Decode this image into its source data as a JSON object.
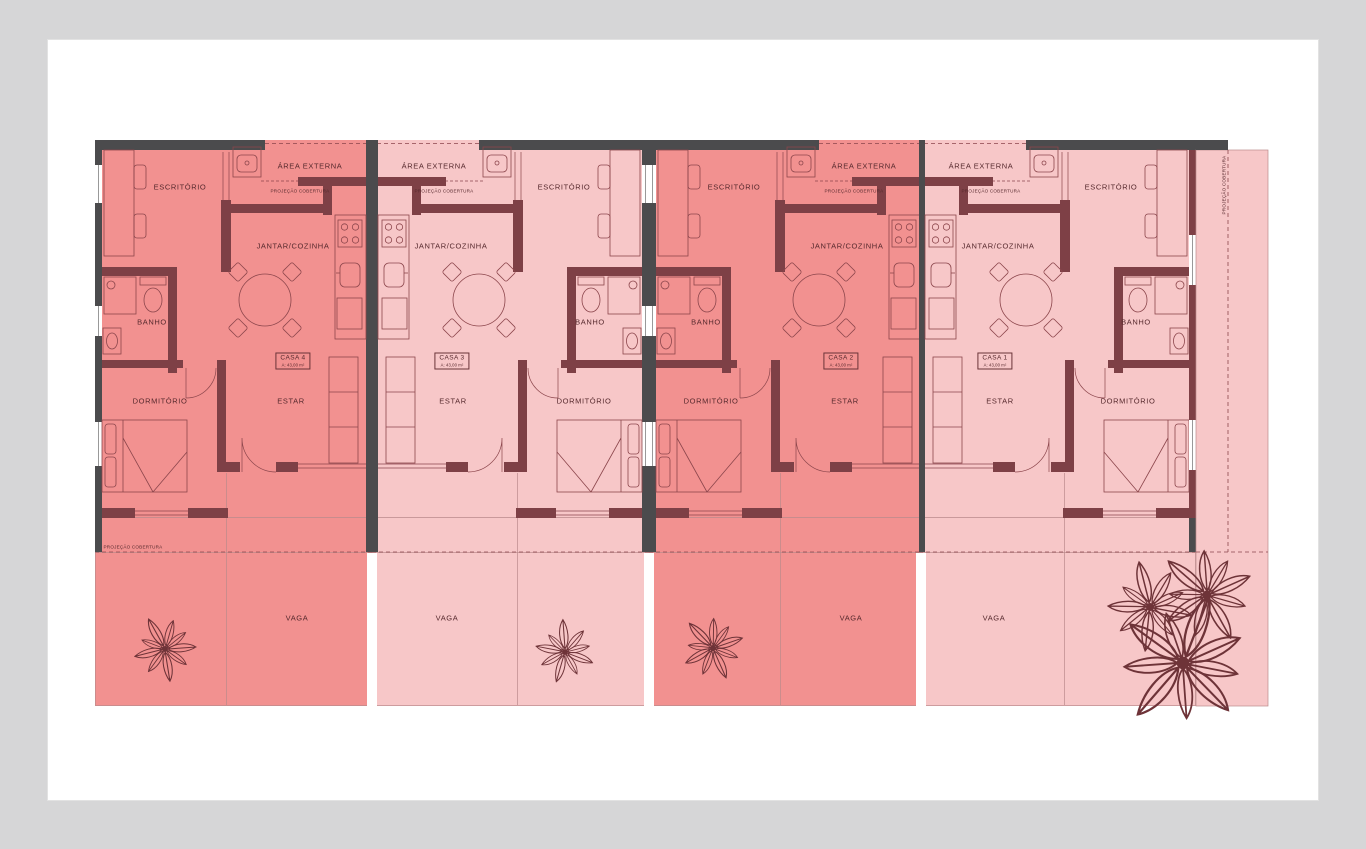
{
  "labels": {
    "escritorio": "ESCRITÓRIO",
    "jantar_cozinha": "JANTAR/COZINHA",
    "banho": "BANHO",
    "dormitorio": "DORMITÓRIO",
    "estar": "ESTAR",
    "area_externa": "ÁREA EXTERNA",
    "vaga": "VAGA",
    "projecao_cobertura": "PROJEÇÃO COBERTURA"
  },
  "units": [
    {
      "name": "CASA 1",
      "area": "A: 43,00 m²"
    },
    {
      "name": "CASA 2",
      "area": "A: 43,00 m²"
    },
    {
      "name": "CASA 3",
      "area": "A: 43,00 m²"
    },
    {
      "name": "CASA 4",
      "area": "A: 43,00 m²"
    }
  ],
  "colors": {
    "background": "#D6D6D7",
    "page": "#FFFFFF",
    "unit_dark": "#F29190",
    "unit_light": "#F7C7C8",
    "wall_masonry": "#7E4046",
    "wall_structure": "#4B4B4D",
    "drawing_line": "#8C464C",
    "text": "#56292D"
  }
}
